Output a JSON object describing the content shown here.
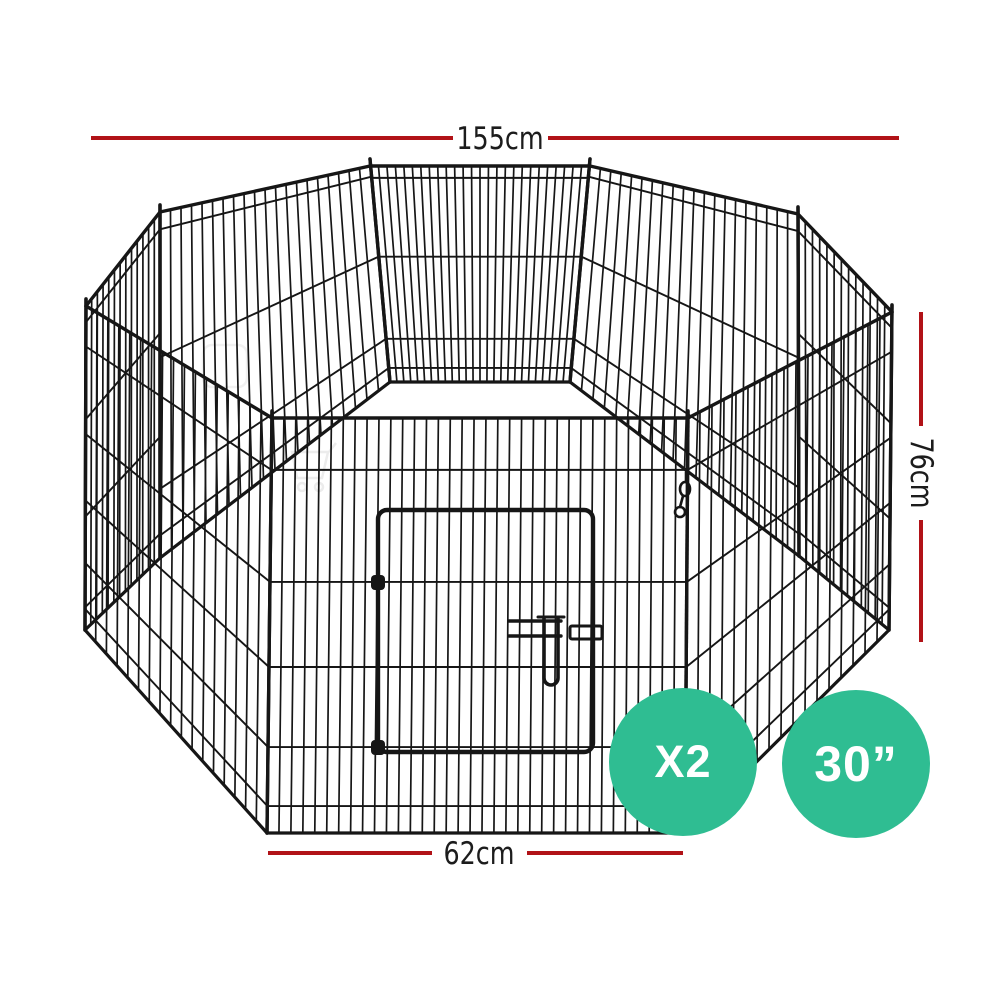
{
  "dimensions": {
    "width_label": "155cm",
    "height_label": "76cm",
    "panel_width_label": "62cm"
  },
  "badges": {
    "quantity_label": "X2",
    "size_label": "30”"
  },
  "icons": {
    "watermark": "shopping-cart-watermark"
  },
  "colors": {
    "dimension_line": "#b11217",
    "label_text": "#1c1c1c",
    "badge_background": "#2fbd92",
    "badge_text": "#ffffff",
    "wire": "#161616",
    "watermark": "#ececec"
  }
}
